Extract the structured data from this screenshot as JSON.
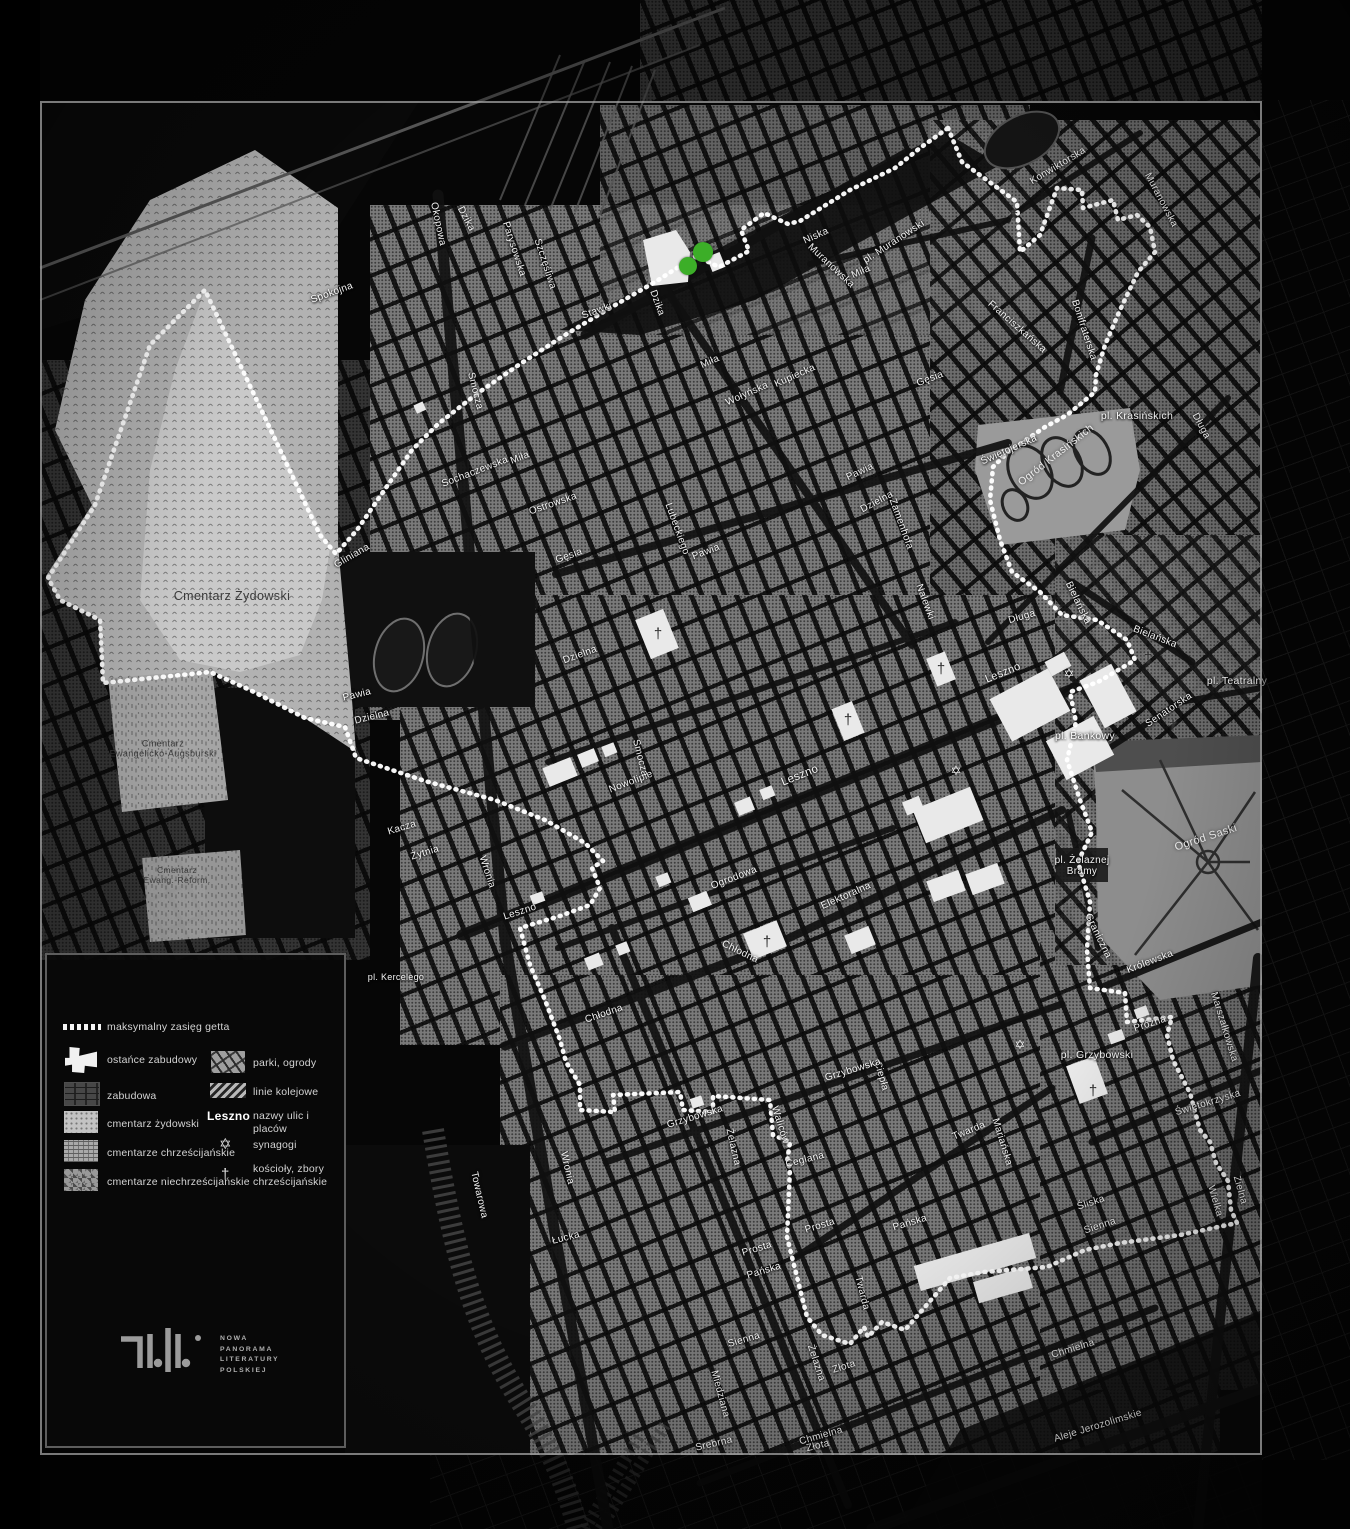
{
  "colors": {
    "marker_green": "#3CAE28",
    "boundary": "#FFFFFF"
  },
  "legend": {
    "items": [
      {
        "id": "boundary",
        "label": "maksymalny zasięg getta"
      },
      {
        "id": "ostance",
        "label": "ostańce zabudowy"
      },
      {
        "id": "zabudowa",
        "label": "zabudowa"
      },
      {
        "id": "cm-zyd",
        "label": "cmentarz żydowski"
      },
      {
        "id": "cm-chrz",
        "label": "cmentarze chrześcijańskie"
      },
      {
        "id": "cm-niechrz",
        "label": "cmentarze niechrześcijańskie"
      },
      {
        "id": "parki",
        "label": "parki, ogrody"
      },
      {
        "id": "kolej",
        "label": "linie kolejowe"
      },
      {
        "id": "nazwy",
        "sample": "Leszno",
        "label": "nazwy ulic i placów"
      },
      {
        "id": "synagogi",
        "label": "synagogi"
      },
      {
        "id": "koscioly",
        "label": "kościoły, zbory chrześcijańskie"
      }
    ]
  },
  "logo": {
    "lines": [
      "NOWA",
      "PANORAMA",
      "LITERATURY",
      "POLSKIEJ"
    ]
  },
  "map": {
    "areas": [
      {
        "t": "Cmentarz Żydowski",
        "x": 232,
        "y": 596,
        "r": 0,
        "s": 12.5,
        "light": false
      },
      {
        "t": "Cmentarz\nEwangelicko-Augsburski",
        "x": 163,
        "y": 749,
        "r": 0,
        "s": 9,
        "light": false
      },
      {
        "t": "Cmentarz\nEwang.-Reform.",
        "x": 177,
        "y": 876,
        "r": 0,
        "s": 8.5,
        "light": false
      },
      {
        "t": "Ogród Krasińskich",
        "x": 1056,
        "y": 455,
        "r": -38,
        "s": 10.5,
        "light": true
      },
      {
        "t": "Ogród Saski",
        "x": 1206,
        "y": 838,
        "r": -18,
        "s": 11,
        "light": true
      }
    ],
    "streets": [
      {
        "t": "Spokojna",
        "x": 332,
        "y": 293,
        "r": -20
      },
      {
        "t": "Okopowa",
        "x": 438,
        "y": 224,
        "r": 78
      },
      {
        "t": "Dzika",
        "x": 466,
        "y": 219,
        "r": 62
      },
      {
        "t": "Parysowska",
        "x": 514,
        "y": 249,
        "r": 72
      },
      {
        "t": "Szczęśliwa",
        "x": 545,
        "y": 264,
        "r": 72
      },
      {
        "t": "Stawki",
        "x": 597,
        "y": 311,
        "r": -20
      },
      {
        "t": "Dzika",
        "x": 657,
        "y": 303,
        "r": 70
      },
      {
        "t": "Niska",
        "x": 816,
        "y": 236,
        "r": -24
      },
      {
        "t": "Muranowska",
        "x": 831,
        "y": 266,
        "r": 43
      },
      {
        "t": "pl. Muranowski",
        "x": 894,
        "y": 242,
        "r": -33
      },
      {
        "t": "Miła",
        "x": 861,
        "y": 272,
        "r": -24
      },
      {
        "t": "Miła",
        "x": 710,
        "y": 362,
        "r": -24
      },
      {
        "t": "Muranowska",
        "x": 1161,
        "y": 200,
        "r": 62
      },
      {
        "t": "Konwiktorska",
        "x": 1058,
        "y": 166,
        "r": -31
      },
      {
        "t": "Franciszkańska",
        "x": 1017,
        "y": 327,
        "r": 41
      },
      {
        "t": "Bonifraterska",
        "x": 1084,
        "y": 330,
        "r": 72
      },
      {
        "t": "pl. Krasińskich",
        "x": 1137,
        "y": 417,
        "r": 0,
        "s": 10.5
      },
      {
        "t": "Długa",
        "x": 1201,
        "y": 426,
        "r": 62
      },
      {
        "t": "Długa",
        "x": 1022,
        "y": 617,
        "r": -16
      },
      {
        "t": "Bielańska",
        "x": 1155,
        "y": 637,
        "r": 21
      },
      {
        "t": "Bielańska",
        "x": 1078,
        "y": 603,
        "r": 64
      },
      {
        "t": "pl. Teatralny",
        "x": 1237,
        "y": 682,
        "r": 0,
        "s": 10.5
      },
      {
        "t": "Senatorska",
        "x": 1169,
        "y": 710,
        "r": -34
      },
      {
        "t": "pl. Bankowy",
        "x": 1085,
        "y": 737,
        "r": 0,
        "s": 10.5
      },
      {
        "t": "pl. Żelaznej\nBramy",
        "x": 1082,
        "y": 866,
        "r": 0,
        "s": 10
      },
      {
        "t": "Królewska",
        "x": 1150,
        "y": 962,
        "r": -21
      },
      {
        "t": "Graniczna",
        "x": 1098,
        "y": 936,
        "r": 64
      },
      {
        "t": "Marszałkowska",
        "x": 1224,
        "y": 1027,
        "r": 73
      },
      {
        "t": "Próżna",
        "x": 1150,
        "y": 1024,
        "r": -18
      },
      {
        "t": "pl. Grzybowski",
        "x": 1097,
        "y": 1056,
        "r": 0,
        "s": 10.5
      },
      {
        "t": "Świętokrzyska",
        "x": 1208,
        "y": 1103,
        "r": -17
      },
      {
        "t": "Zielna",
        "x": 1240,
        "y": 1190,
        "r": 74
      },
      {
        "t": "Wielka",
        "x": 1215,
        "y": 1201,
        "r": 74
      },
      {
        "t": "Śliska",
        "x": 1091,
        "y": 1203,
        "r": -18
      },
      {
        "t": "Sienna",
        "x": 1100,
        "y": 1226,
        "r": -18
      },
      {
        "t": "Sienna",
        "x": 744,
        "y": 1340,
        "r": -16
      },
      {
        "t": "Złota",
        "x": 844,
        "y": 1367,
        "r": -17
      },
      {
        "t": "Złota",
        "x": 818,
        "y": 1446,
        "r": -14
      },
      {
        "t": "Chmielna",
        "x": 1073,
        "y": 1349,
        "r": -17
      },
      {
        "t": "Chmielna",
        "x": 821,
        "y": 1436,
        "r": -16
      },
      {
        "t": "Aleje Jerozolimskie",
        "x": 1098,
        "y": 1426,
        "r": -17
      },
      {
        "t": "Srebrna",
        "x": 714,
        "y": 1444,
        "r": -13
      },
      {
        "t": "Towarowa",
        "x": 479,
        "y": 1195,
        "r": 77
      },
      {
        "t": "Wronia",
        "x": 567,
        "y": 1168,
        "r": 77
      },
      {
        "t": "Łucka",
        "x": 566,
        "y": 1238,
        "r": -14
      },
      {
        "t": "Prosta",
        "x": 820,
        "y": 1226,
        "r": -17
      },
      {
        "t": "Prosta",
        "x": 757,
        "y": 1249,
        "r": -17
      },
      {
        "t": "Pańska",
        "x": 910,
        "y": 1223,
        "r": -17
      },
      {
        "t": "Pańska",
        "x": 764,
        "y": 1271,
        "r": -17
      },
      {
        "t": "Twarda",
        "x": 969,
        "y": 1131,
        "r": -22
      },
      {
        "t": "Twarda",
        "x": 862,
        "y": 1293,
        "r": 76
      },
      {
        "t": "Mariańska",
        "x": 1002,
        "y": 1142,
        "r": 73
      },
      {
        "t": "Miedziana",
        "x": 720,
        "y": 1394,
        "r": 75
      },
      {
        "t": "Ceglana",
        "x": 805,
        "y": 1160,
        "r": -14
      },
      {
        "t": "Waliców",
        "x": 780,
        "y": 1125,
        "r": 73
      },
      {
        "t": "Żelazna",
        "x": 733,
        "y": 1147,
        "r": 77
      },
      {
        "t": "Żelazna",
        "x": 816,
        "y": 1363,
        "r": 72
      },
      {
        "t": "Ciepła",
        "x": 881,
        "y": 1076,
        "r": 74
      },
      {
        "t": "Grzybowska",
        "x": 695,
        "y": 1117,
        "r": -17
      },
      {
        "t": "Grzybowska",
        "x": 853,
        "y": 1070,
        "r": -17
      },
      {
        "t": "Chłodna",
        "x": 604,
        "y": 1014,
        "r": -19
      },
      {
        "t": "Chłodna",
        "x": 740,
        "y": 952,
        "r": 26
      },
      {
        "t": "Ogrodowa",
        "x": 734,
        "y": 878,
        "r": -21
      },
      {
        "t": "Elektoralna",
        "x": 846,
        "y": 896,
        "r": -24
      },
      {
        "t": "Leszno",
        "x": 800,
        "y": 776,
        "r": -22,
        "s": 11.5
      },
      {
        "t": "Leszno",
        "x": 1003,
        "y": 673,
        "r": -22,
        "s": 11
      },
      {
        "t": "Leszno",
        "x": 520,
        "y": 912,
        "r": -18
      },
      {
        "t": "pl. Kercelego",
        "x": 396,
        "y": 978,
        "r": 0,
        "s": 9
      },
      {
        "t": "Kacza",
        "x": 402,
        "y": 828,
        "r": -17
      },
      {
        "t": "Żytnia",
        "x": 425,
        "y": 853,
        "r": -17
      },
      {
        "t": "Wronia",
        "x": 487,
        "y": 872,
        "r": 72
      },
      {
        "t": "Nowolipie",
        "x": 631,
        "y": 782,
        "r": -21
      },
      {
        "t": "Smocza",
        "x": 640,
        "y": 758,
        "r": 76
      },
      {
        "t": "Smocza",
        "x": 475,
        "y": 391,
        "r": 76
      },
      {
        "t": "Sochaczewska",
        "x": 475,
        "y": 472,
        "r": -21
      },
      {
        "t": "Miła",
        "x": 520,
        "y": 458,
        "r": -21
      },
      {
        "t": "Ostrowska",
        "x": 553,
        "y": 504,
        "r": -19
      },
      {
        "t": "Gęsia",
        "x": 569,
        "y": 556,
        "r": -19
      },
      {
        "t": "Gęsia",
        "x": 930,
        "y": 379,
        "r": -21
      },
      {
        "t": "Wołyńska",
        "x": 747,
        "y": 394,
        "r": -24
      },
      {
        "t": "Kupiecka",
        "x": 795,
        "y": 376,
        "r": -24
      },
      {
        "t": "Lubeckiego",
        "x": 677,
        "y": 529,
        "r": 70
      },
      {
        "t": "Pawia",
        "x": 706,
        "y": 552,
        "r": -21
      },
      {
        "t": "Pawia",
        "x": 860,
        "y": 472,
        "r": -25
      },
      {
        "t": "Pawia",
        "x": 357,
        "y": 695,
        "r": -14
      },
      {
        "t": "Dzielna",
        "x": 580,
        "y": 655,
        "r": -20
      },
      {
        "t": "Dzielna",
        "x": 372,
        "y": 717,
        "r": -14
      },
      {
        "t": "Dzielna",
        "x": 877,
        "y": 502,
        "r": -28
      },
      {
        "t": "Zamenhofa",
        "x": 901,
        "y": 524,
        "r": 70
      },
      {
        "t": "Nalewki",
        "x": 925,
        "y": 602,
        "r": 70
      },
      {
        "t": "Świętojerska",
        "x": 1009,
        "y": 450,
        "r": -24
      },
      {
        "t": "Gliniana",
        "x": 352,
        "y": 556,
        "r": -30
      }
    ],
    "markers": {
      "green_dots": [
        {
          "x": 688,
          "y": 266,
          "r": 9
        },
        {
          "x": 703,
          "y": 252,
          "r": 10
        }
      ],
      "synagogues": [
        {
          "x": 1069,
          "y": 674
        },
        {
          "x": 956,
          "y": 771
        },
        {
          "x": 1020,
          "y": 1045
        }
      ],
      "churches": [
        {
          "x": 658,
          "y": 634
        },
        {
          "x": 848,
          "y": 720
        },
        {
          "x": 941,
          "y": 669
        },
        {
          "x": 767,
          "y": 942
        },
        {
          "x": 1093,
          "y": 1091
        },
        {
          "x": 1148,
          "y": 658
        },
        {
          "x": 1173,
          "y": 726
        },
        {
          "x": 1014,
          "y": 216
        }
      ]
    },
    "boundary": [
      [
        948,
        128
      ],
      [
        962,
        162
      ],
      [
        1017,
        202
      ],
      [
        1020,
        252
      ],
      [
        1040,
        235
      ],
      [
        1057,
        188
      ],
      [
        1082,
        190
      ],
      [
        1083,
        208
      ],
      [
        1113,
        200
      ],
      [
        1118,
        220
      ],
      [
        1137,
        215
      ],
      [
        1150,
        227
      ],
      [
        1155,
        252
      ],
      [
        1138,
        272
      ],
      [
        1120,
        310
      ],
      [
        1105,
        345
      ],
      [
        1096,
        375
      ],
      [
        1095,
        392
      ],
      [
        1067,
        415
      ],
      [
        1045,
        427
      ],
      [
        1023,
        442
      ],
      [
        1008,
        452
      ],
      [
        993,
        467
      ],
      [
        990,
        500
      ],
      [
        1000,
        540
      ],
      [
        1012,
        572
      ],
      [
        1040,
        592
      ],
      [
        1062,
        615
      ],
      [
        1097,
        620
      ],
      [
        1127,
        640
      ],
      [
        1135,
        660
      ],
      [
        1098,
        682
      ],
      [
        1070,
        692
      ],
      [
        1076,
        722
      ],
      [
        1067,
        760
      ],
      [
        1080,
        800
      ],
      [
        1092,
        832
      ],
      [
        1078,
        862
      ],
      [
        1090,
        902
      ],
      [
        1087,
        950
      ],
      [
        1090,
        988
      ],
      [
        1125,
        993
      ],
      [
        1127,
        1022
      ],
      [
        1172,
        1017
      ],
      [
        1167,
        1035
      ],
      [
        1173,
        1060
      ],
      [
        1190,
        1093
      ],
      [
        1200,
        1130
      ],
      [
        1210,
        1142
      ],
      [
        1216,
        1163
      ],
      [
        1228,
        1181
      ],
      [
        1231,
        1210
      ],
      [
        1237,
        1223
      ],
      [
        1180,
        1235
      ],
      [
        1120,
        1243
      ],
      [
        1085,
        1250
      ],
      [
        1047,
        1267
      ],
      [
        984,
        1272
      ],
      [
        950,
        1278
      ],
      [
        905,
        1330
      ],
      [
        882,
        1322
      ],
      [
        868,
        1337
      ],
      [
        864,
        1327
      ],
      [
        850,
        1344
      ],
      [
        822,
        1335
      ],
      [
        807,
        1317
      ],
      [
        787,
        1237
      ],
      [
        790,
        1168
      ],
      [
        787,
        1162
      ],
      [
        790,
        1142
      ],
      [
        773,
        1135
      ],
      [
        770,
        1100
      ],
      [
        713,
        1096
      ],
      [
        713,
        1112
      ],
      [
        683,
        1110
      ],
      [
        680,
        1092
      ],
      [
        613,
        1095
      ],
      [
        615,
        1112
      ],
      [
        580,
        1110
      ],
      [
        580,
        1085
      ],
      [
        566,
        1062
      ],
      [
        560,
        1040
      ],
      [
        545,
        1000
      ],
      [
        530,
        965
      ],
      [
        520,
        928
      ],
      [
        560,
        916
      ],
      [
        590,
        905
      ],
      [
        600,
        888
      ],
      [
        592,
        868
      ],
      [
        603,
        861
      ],
      [
        585,
        843
      ],
      [
        545,
        820
      ],
      [
        495,
        800
      ],
      [
        425,
        781
      ],
      [
        356,
        758
      ],
      [
        345,
        727
      ],
      [
        305,
        718
      ],
      [
        250,
        690
      ],
      [
        210,
        672
      ],
      [
        103,
        683
      ],
      [
        100,
        620
      ],
      [
        60,
        600
      ],
      [
        48,
        578
      ],
      [
        95,
        505
      ],
      [
        150,
        345
      ],
      [
        205,
        290
      ],
      [
        320,
        535
      ],
      [
        336,
        554
      ],
      [
        357,
        530
      ],
      [
        383,
        492
      ],
      [
        412,
        450
      ],
      [
        438,
        424
      ],
      [
        478,
        393
      ],
      [
        520,
        364
      ],
      [
        565,
        335
      ],
      [
        610,
        308
      ],
      [
        655,
        282
      ],
      [
        696,
        256
      ],
      [
        719,
        267
      ],
      [
        749,
        251
      ],
      [
        741,
        230
      ],
      [
        764,
        213
      ],
      [
        788,
        224
      ],
      [
        800,
        221
      ],
      [
        850,
        190
      ],
      [
        895,
        168
      ],
      [
        920,
        148
      ]
    ]
  }
}
